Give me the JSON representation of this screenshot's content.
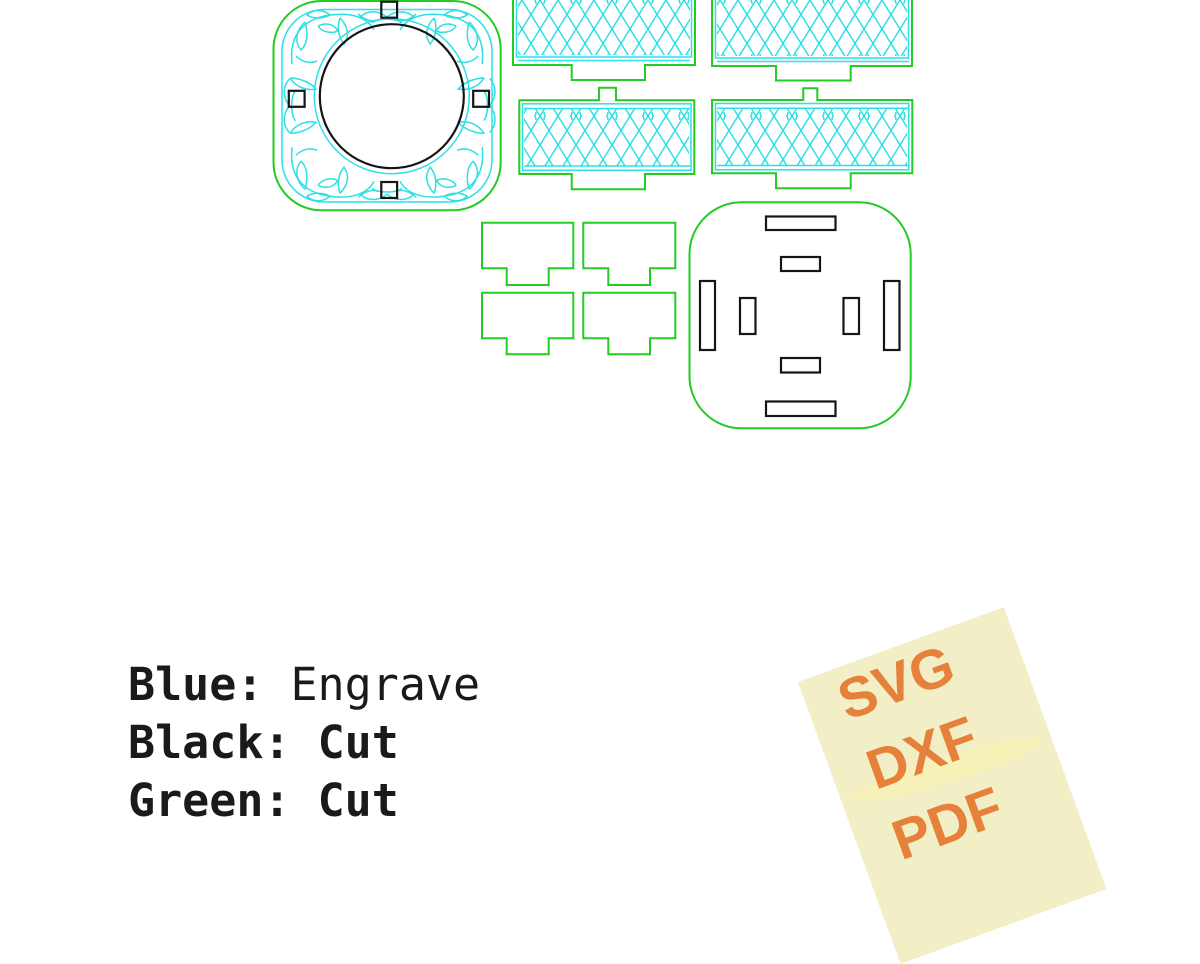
{
  "legend": {
    "items": [
      {
        "label": "Blue:",
        "value": "Engrave",
        "hex": "#2ce0e6"
      },
      {
        "label": "Black:",
        "value": "Cut",
        "hex": "#151515"
      },
      {
        "label": "Green:",
        "value": "Cut",
        "hex": "#22cc22"
      }
    ]
  },
  "format_card": {
    "formats": [
      "SVG",
      "DXF",
      "PDF"
    ],
    "background": "#f2efc7",
    "text_color": "#e5813a"
  },
  "drawing_colors": {
    "engrave_blue": "#2ce0e6",
    "cut_green": "#22cc22",
    "cut_black": "#151515",
    "canvas_background": "#ffffff"
  }
}
